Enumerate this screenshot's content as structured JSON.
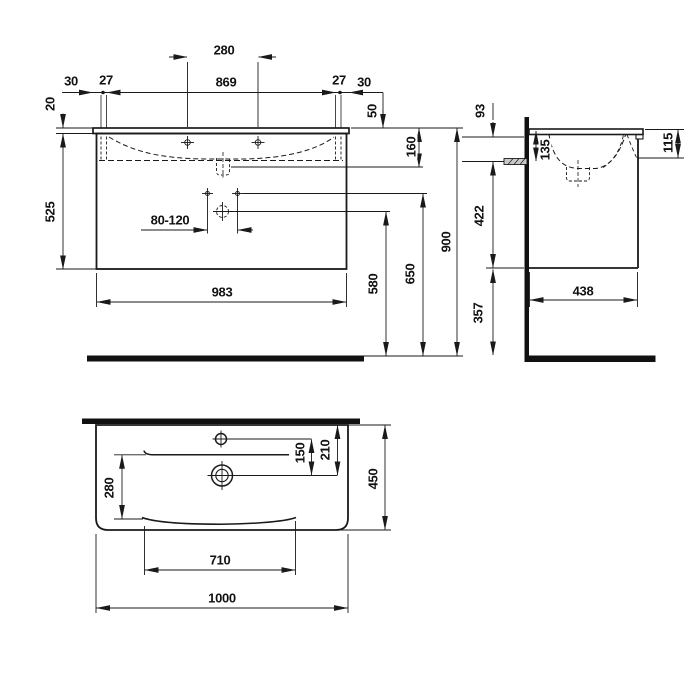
{
  "drawing": {
    "title": "washbasin-with-vanity-unit-technical-drawing",
    "views": {
      "front": {
        "name": "front-view",
        "dims": {
          "tap_spacing": "280",
          "edge_left": "30",
          "inset_left": "27",
          "tap_span": "869",
          "inset_right": "27",
          "edge_right": "30",
          "top_thickness": "20",
          "tap_height": "50",
          "basin_depth": "160",
          "cabinet_height": "525",
          "drain_range": "80-120",
          "cabinet_width": "983",
          "trap_height": "580",
          "fixing_height": "650",
          "total_height": "900"
        }
      },
      "side": {
        "name": "side-view",
        "dims": {
          "fixing_offset": "93",
          "fixing_depth": "135",
          "front_height": "115",
          "fixing_to_bottom": "422",
          "cabinet_depth": "438",
          "bottom_clearance": "357"
        }
      },
      "plan": {
        "name": "plan-view",
        "dims": {
          "tap_to_drain": "150",
          "rear_to_drain": "210",
          "bowl_depth": "280",
          "total_depth": "450",
          "bowl_width": "710",
          "total_width": "1000"
        }
      }
    },
    "line_color": "#1a1a1a"
  }
}
